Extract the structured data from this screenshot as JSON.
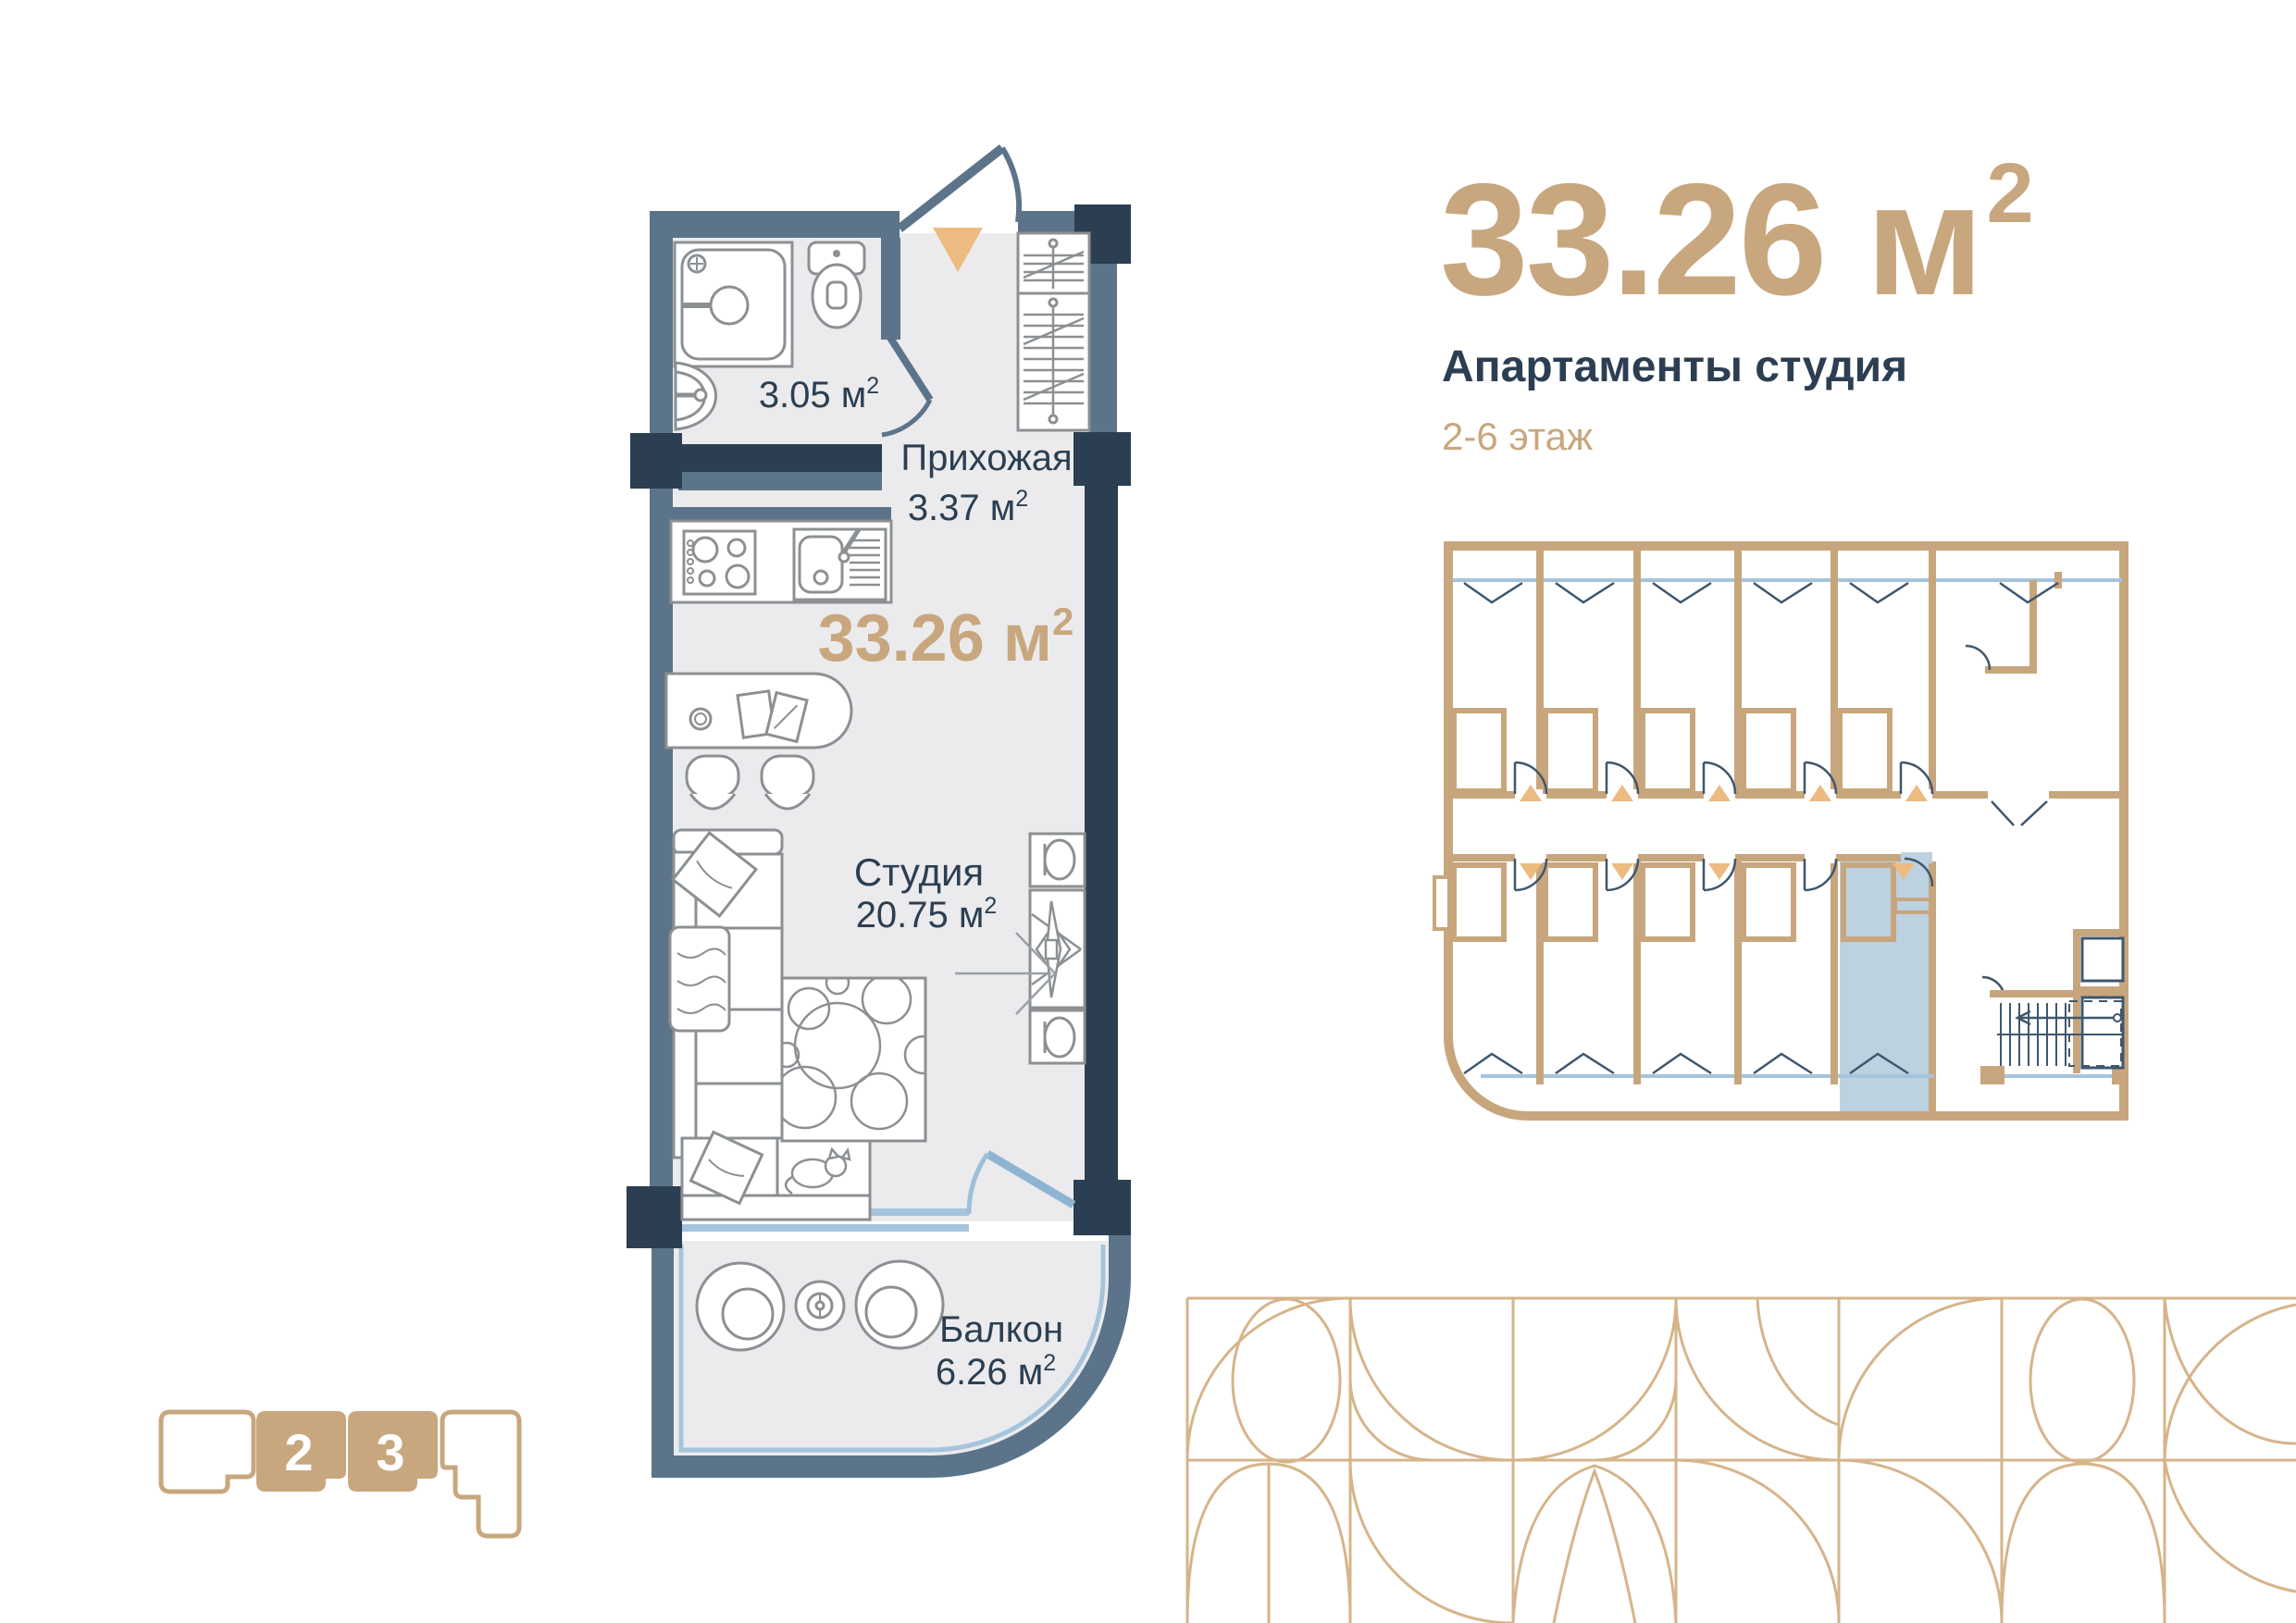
{
  "header": {
    "area_main": "33.26 м",
    "area_sup": "2",
    "subtitle": "Апартаменты студия",
    "floors": "2-6 этаж"
  },
  "apartment_plan": {
    "bathroom": {
      "area_main": "3.05 м",
      "area_sup": "2"
    },
    "hallway": {
      "name": "Прихожая",
      "area_main": "3.37 м",
      "area_sup": "2"
    },
    "total_area": {
      "main": "33.26 м",
      "sup": "2"
    },
    "studio": {
      "name": "Студия",
      "area_main": "20.75 м",
      "area_sup": "2"
    },
    "balcony": {
      "name": "Балкон",
      "area_main": "6.26 м",
      "area_sup": "2"
    }
  },
  "site_map": {
    "building_2_label": "2",
    "building_3_label": "3"
  },
  "colors": {
    "tan": "#C8A77E",
    "pattern_tan": "#D6B48A",
    "triangle_tan": "#ECBB81",
    "navy": "#2C3F52",
    "slate": "#5C7489",
    "floor_gray": "#EBEBED",
    "furniture_gray": "#8C9093",
    "window_blue": "#A5C4DC",
    "door_blue": "#8FB4D2",
    "highlight_blue": "#BCD2E0"
  }
}
